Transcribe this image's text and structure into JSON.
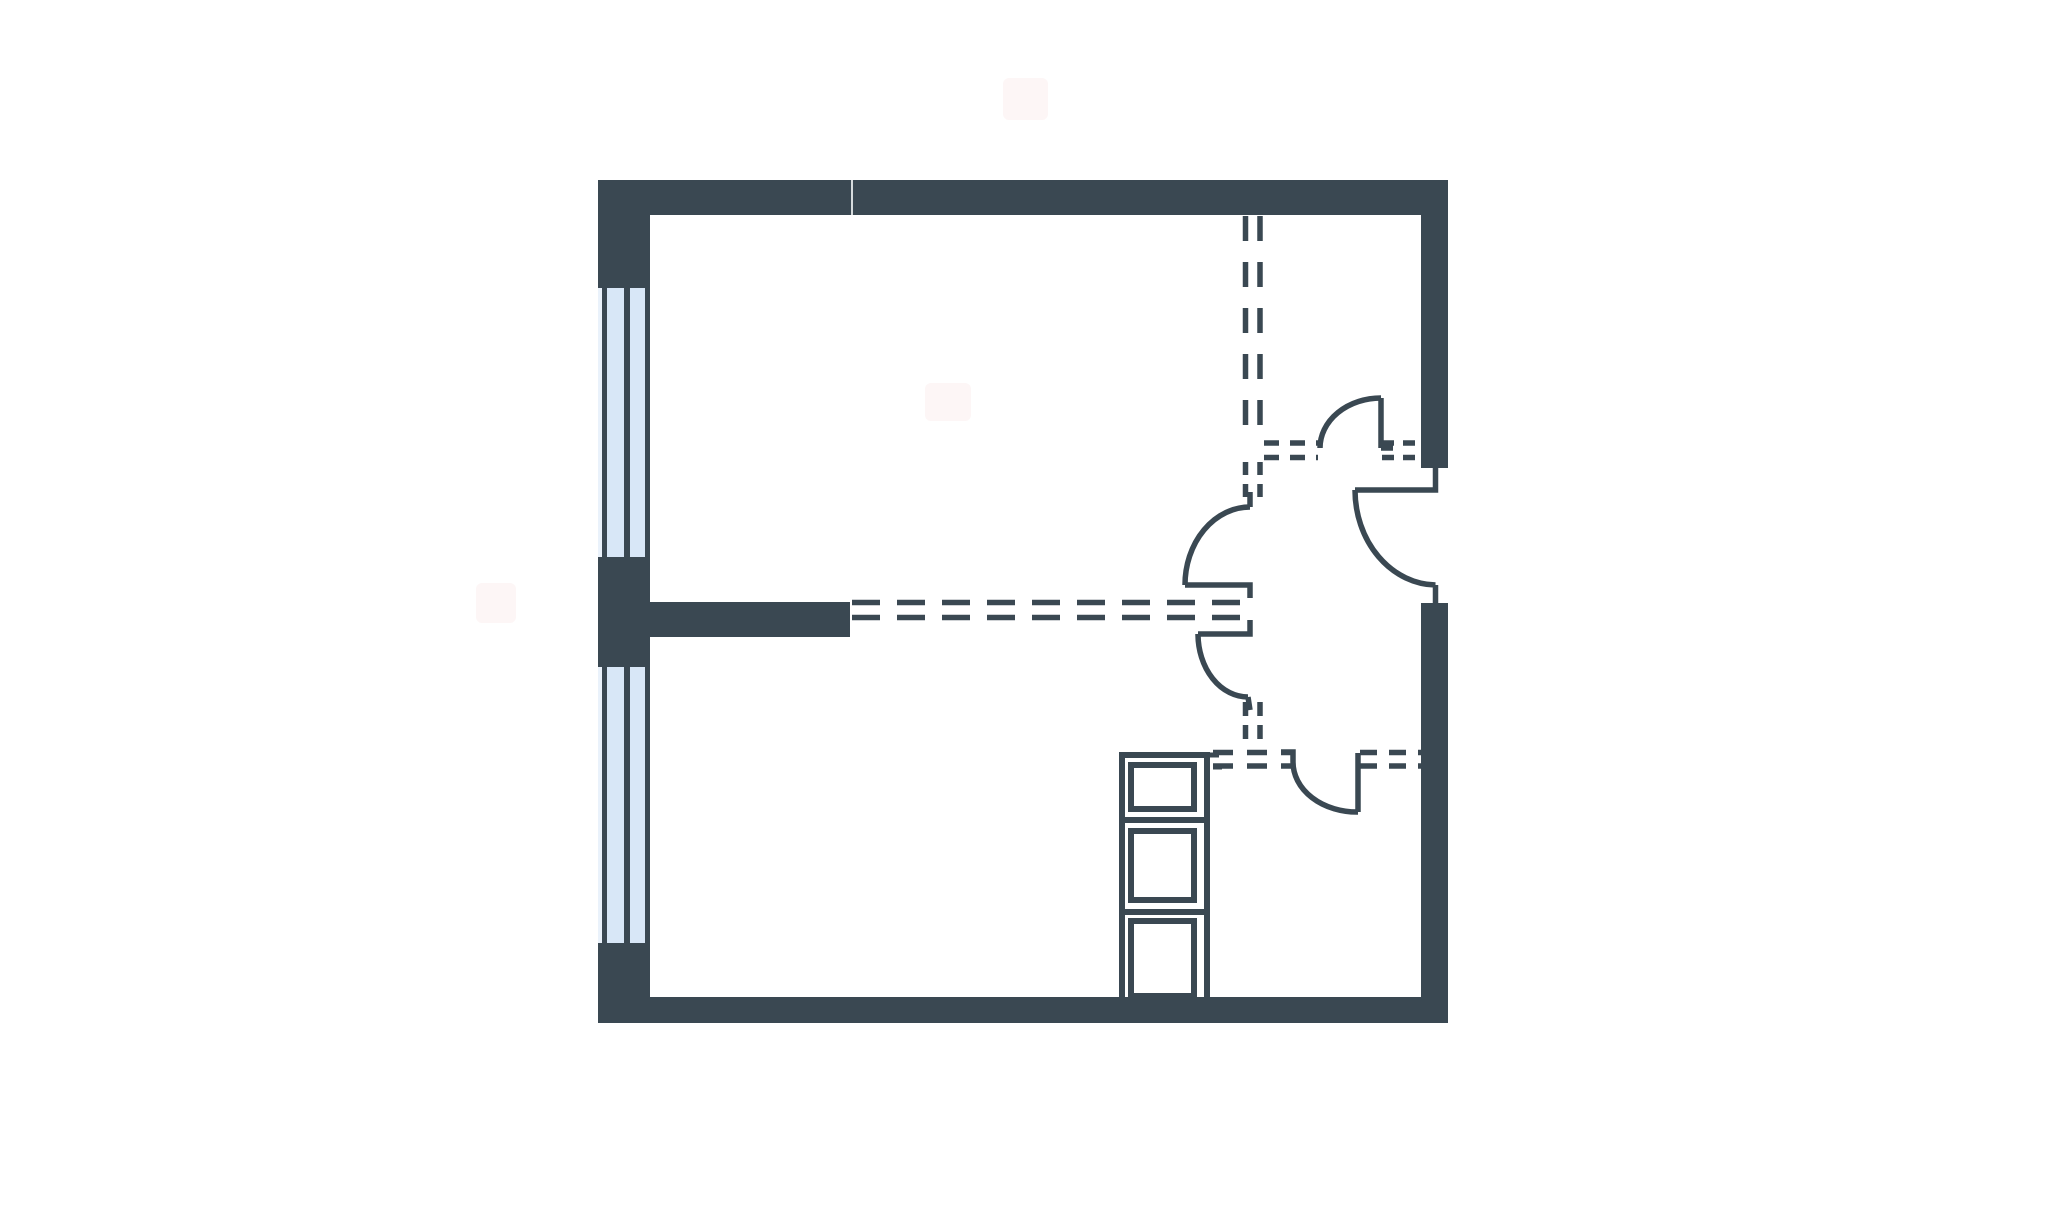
{
  "canvas": {
    "width": 2048,
    "height": 1205,
    "background": "#ffffff"
  },
  "palette": {
    "wall": "#3a4852",
    "window_pane": "#d8e7f7",
    "window_highlight": "#eaf2fb",
    "wall_seam": "#e8ebec",
    "watermark": "#fdf6f6",
    "floor": "#ffffff"
  },
  "stroke": {
    "dash_width": 5.5,
    "door_width": 5.5,
    "shaft_box_width": 6,
    "tick_width": 5
  },
  "watermarks": [
    {
      "name": "watermark-blob-top",
      "x": 1003,
      "y": 78,
      "w": 45,
      "h": 42
    },
    {
      "name": "watermark-blob-room",
      "x": 925,
      "y": 383,
      "w": 46,
      "h": 38
    },
    {
      "name": "watermark-blob-left",
      "x": 476,
      "y": 583,
      "w": 40,
      "h": 40
    }
  ],
  "walls": [
    {
      "name": "wall-exterior-top",
      "x": 598,
      "y": 180,
      "w": 850,
      "h": 35
    },
    {
      "name": "wall-corner-top-left",
      "x": 598,
      "y": 180,
      "w": 52,
      "h": 108
    },
    {
      "name": "wall-left-middle-pier",
      "x": 598,
      "y": 557,
      "w": 52,
      "h": 110
    },
    {
      "name": "wall-left-bottom-pier",
      "x": 598,
      "y": 943,
      "w": 52,
      "h": 80
    },
    {
      "name": "wall-exterior-bottom",
      "x": 650,
      "y": 997,
      "w": 798,
      "h": 26
    },
    {
      "name": "wall-exterior-right-upper",
      "x": 1421,
      "y": 180,
      "w": 27,
      "h": 288
    },
    {
      "name": "wall-exterior-right-lower",
      "x": 1421,
      "y": 603,
      "w": 27,
      "h": 394
    },
    {
      "name": "wall-interior-stub",
      "x": 650,
      "y": 602,
      "w": 200,
      "h": 35
    }
  ],
  "wall_seams": [
    {
      "name": "top-wall-panel-seam",
      "x": 851,
      "y": 180,
      "w": 2,
      "h": 35
    }
  ],
  "windows": [
    {
      "name": "window-upper-left",
      "x": 598,
      "y": 288,
      "w": 52,
      "h": 269
    },
    {
      "name": "window-lower-left",
      "x": 598,
      "y": 667,
      "w": 52,
      "h": 276
    }
  ],
  "window_bars": {
    "highlight_w": 4,
    "bars": [
      {
        "dx": 4,
        "w": 5
      },
      {
        "dx": 26,
        "w": 6
      },
      {
        "dx": 47,
        "w": 5
      }
    ]
  },
  "dashed_partitions": [
    {
      "name": "partition-vert-left-upper",
      "x1": 1245.5,
      "y1": 216,
      "x2": 1245.5,
      "y2": 438,
      "dash": "25 21"
    },
    {
      "name": "partition-vert-right-upper",
      "x1": 1260,
      "y1": 216,
      "x2": 1260,
      "y2": 438,
      "dash": "25 21"
    },
    {
      "name": "partition-vert-left-mid",
      "x1": 1245.5,
      "y1": 462,
      "x2": 1245.5,
      "y2": 503,
      "dash": "13 9"
    },
    {
      "name": "partition-vert-right-mid",
      "x1": 1260,
      "y1": 462,
      "x2": 1260,
      "y2": 503,
      "dash": "13 9"
    },
    {
      "name": "partition-vert-left-lower",
      "x1": 1245.5,
      "y1": 702,
      "x2": 1245.5,
      "y2": 748,
      "dash": "14 9"
    },
    {
      "name": "partition-vert-right-lower",
      "x1": 1260,
      "y1": 702,
      "x2": 1260,
      "y2": 748,
      "dash": "14 9"
    },
    {
      "name": "partition-h1-upper-left",
      "x1": 1264,
      "y1": 443,
      "x2": 1318,
      "y2": 443,
      "dash": "15 11"
    },
    {
      "name": "partition-h1-lower-left",
      "x1": 1264,
      "y1": 457.5,
      "x2": 1318,
      "y2": 457.5,
      "dash": "15 11"
    },
    {
      "name": "partition-h1-upper-right",
      "x1": 1382,
      "y1": 443,
      "x2": 1421,
      "y2": 443,
      "dash": "12 9"
    },
    {
      "name": "partition-h1-lower-right",
      "x1": 1382,
      "y1": 457.5,
      "x2": 1421,
      "y2": 457.5,
      "dash": "12 9"
    },
    {
      "name": "partition-h2-upper",
      "x1": 852,
      "y1": 602.5,
      "x2": 1240,
      "y2": 602.5,
      "dash": "28 17"
    },
    {
      "name": "partition-h2-lower",
      "x1": 852,
      "y1": 617.5,
      "x2": 1240,
      "y2": 617.5,
      "dash": "28 17"
    },
    {
      "name": "partition-h3-upper-left",
      "x1": 1213,
      "y1": 752.5,
      "x2": 1291,
      "y2": 752.5,
      "dash": "20 14"
    },
    {
      "name": "partition-h3-lower-left",
      "x1": 1213,
      "y1": 766,
      "x2": 1291,
      "y2": 766,
      "dash": "20 14"
    },
    {
      "name": "partition-h3-upper-right",
      "x1": 1360,
      "y1": 752.5,
      "x2": 1421,
      "y2": 752.5,
      "dash": "17 12"
    },
    {
      "name": "partition-h3-lower-right",
      "x1": 1360,
      "y1": 766,
      "x2": 1421,
      "y2": 766,
      "dash": "17 12"
    }
  ],
  "doors": [
    {
      "name": "door-hall-upper",
      "path": "M1381,398 L1381,448 M1381,448 L1393,448 M1320,448 A61,50 0 0 1 1381,398"
    },
    {
      "name": "door-right-room",
      "path": "M1435.5,468 L1435.5,490 L1355,490 M1355,490 A82,95 0 0 0 1435.5,585 M1435.5,585 L1435.5,607"
    },
    {
      "name": "door-middle-upper",
      "path": "M1250,492 L1250,507 M1185,585 A65,78 0 0 1 1250,507 M1185,585 L1250,585 L1250,598"
    },
    {
      "name": "door-middle-lower",
      "path": "M1250,620 L1250,634 L1198,634 M1198,634 A50,63 0 0 0 1248,697 M1248,697 L1250,710"
    },
    {
      "name": "door-bottom-room",
      "path": "M1281,752 L1293,752 L1293,762 M1293,762 A64,50 0 0 0 1358,812 M1358,753 L1358,812"
    }
  ],
  "shaft": {
    "frame": [
      {
        "name": "shaft-frame-left",
        "x": 1119,
        "y": 752,
        "w": 6,
        "h": 245
      },
      {
        "name": "shaft-frame-right",
        "x": 1204,
        "y": 752,
        "w": 6,
        "h": 245
      },
      {
        "name": "shaft-frame-top",
        "x": 1119,
        "y": 752,
        "w": 91,
        "h": 6
      },
      {
        "name": "shaft-divider-upper",
        "x": 1119,
        "y": 817,
        "w": 91,
        "h": 6
      },
      {
        "name": "shaft-divider-lower",
        "x": 1119,
        "y": 909,
        "w": 91,
        "h": 6
      }
    ],
    "boxes": [
      {
        "name": "shaft-box-top",
        "x": 1131,
        "y": 765,
        "w": 63,
        "h": 44
      },
      {
        "name": "shaft-box-middle",
        "x": 1131,
        "y": 831,
        "w": 63,
        "h": 69
      },
      {
        "name": "shaft-box-bottom",
        "x": 1131,
        "y": 921,
        "w": 63,
        "h": 75
      }
    ],
    "ticks": [
      {
        "name": "shaft-top-tick",
        "path": "M1210,755 L1219,755 M1213,767 L1222,767"
      }
    ]
  }
}
